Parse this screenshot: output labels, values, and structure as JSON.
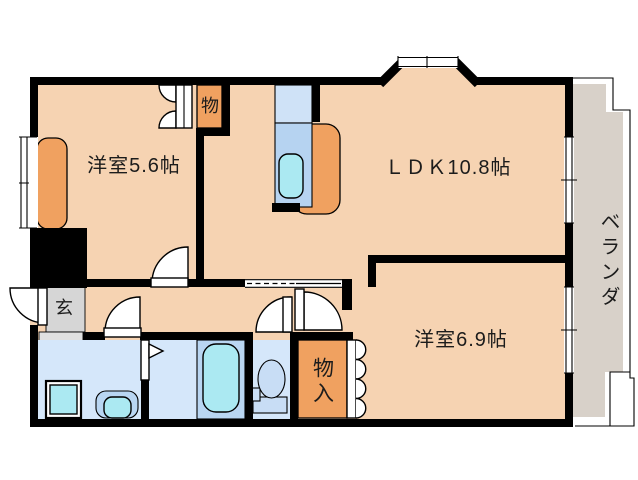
{
  "rooms": {
    "western_room_1": {
      "label": "洋室5.6帖"
    },
    "ldk": {
      "label": "ＬＤＫ10.8帖"
    },
    "western_room_2": {
      "label": "洋室6.9帖"
    },
    "veranda": {
      "label": "ベランダ"
    },
    "entrance": {
      "label": "玄"
    },
    "closet": {
      "label": "物"
    },
    "storage": {
      "label": "物入"
    }
  },
  "colors": {
    "wall": "#000000",
    "floor": "#f6d3b2",
    "orange": "#f0a160",
    "waterfloor": "#d5e7fa",
    "counterblue": "#b6d3f1",
    "counterbluelight": "#cfe2f7",
    "cyan": "#abe9f2",
    "platformblue": "#b9d6f2",
    "fixture": "#c8ddf5",
    "entrygrey": "#d6d6d6",
    "stepgrey": "#e0e0e0",
    "veranda": "#d8d1c9",
    "text": "#1c1c1c"
  }
}
